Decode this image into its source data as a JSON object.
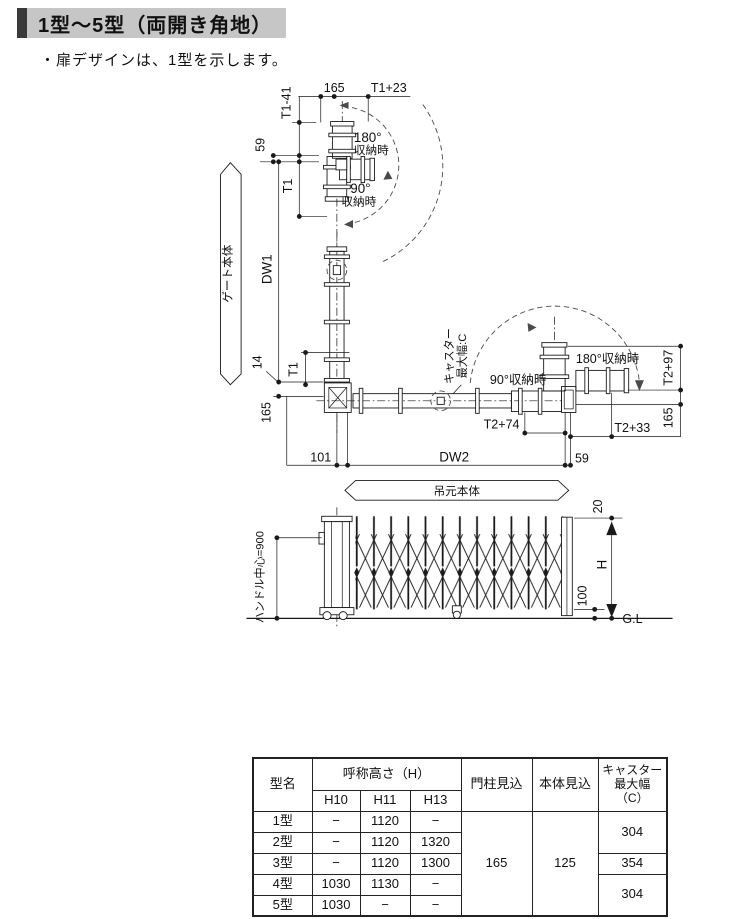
{
  "colors": {
    "header_bg": "#c6c6c6",
    "accent_bar": "#3a3a3a",
    "line": "#1a1a1a"
  },
  "header": {
    "title": "1型～5型（両開き角地）",
    "note": "・扉デザインは、1型を示します。"
  },
  "plan": {
    "gate_body": "ゲート本体",
    "hinge_body": "吊元本体",
    "d165_top": "165",
    "t1p23": "T1+23",
    "t1m41": "T1-41",
    "d59_top": "59",
    "t1_upper": "T1",
    "dw1": "DW1",
    "t1_lower": "T1",
    "d14": "14",
    "d165_left": "165",
    "d101": "101",
    "dw2": "DW2",
    "d59_right": "59",
    "t2p74": "T2+74",
    "t2p33": "T2+33",
    "t2p97": "T2+97",
    "d165_right": "165",
    "top_180": "180°",
    "top_180_sub": "収納時",
    "top_90": "90°",
    "top_90_sub": "収納時",
    "right_90": "90°収納時",
    "right_180": "180°収納時",
    "caster_label_1": "キャスター",
    "caster_label_2": "最大幅:C"
  },
  "elevation": {
    "handle_center": "ハンドル中心=900",
    "d20": "20",
    "dh": "H",
    "d100": "100",
    "gl": "G.L"
  },
  "spec_table": {
    "col_model": "型名",
    "col_height": "呼称高さ（H）",
    "sub_h10": "H10",
    "sub_h11": "H11",
    "sub_h13": "H13",
    "col_pillar": "門柱見込",
    "col_body": "本体見込",
    "col_caster_l1": "キャスター",
    "col_caster_l2": "最大幅",
    "col_caster_l3": "（C）",
    "rows": [
      {
        "name": "1型",
        "h10": "−",
        "h11": "1120",
        "h13": "−"
      },
      {
        "name": "2型",
        "h10": "−",
        "h11": "1120",
        "h13": "1320"
      },
      {
        "name": "3型",
        "h10": "−",
        "h11": "1120",
        "h13": "1300"
      },
      {
        "name": "4型",
        "h10": "1030",
        "h11": "1130",
        "h13": "−"
      },
      {
        "name": "5型",
        "h10": "1030",
        "h11": "−",
        "h13": "−"
      }
    ],
    "pillar_depth": "165",
    "body_depth": "125",
    "caster_12": "304",
    "caster_3": "354",
    "caster_45": "304"
  }
}
